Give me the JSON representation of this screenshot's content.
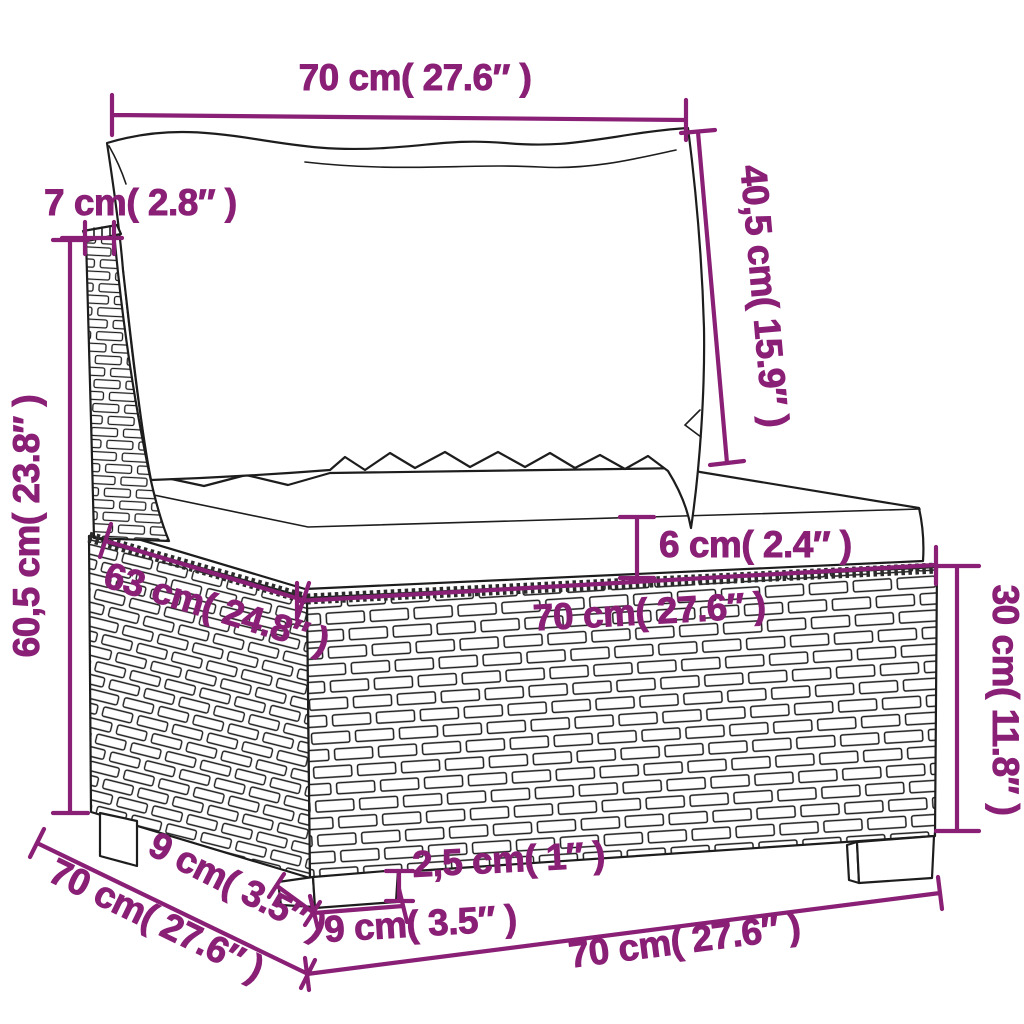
{
  "page": {
    "background": "#ffffff",
    "accent_color": "#8A1F76",
    "outline_color": "#1d1d1d"
  },
  "diagram": {
    "product": "poly rattan garden sofa middle section with back and seat cushions",
    "view": "front-left perspective line drawing with dimension annotations",
    "units": "cm (inches)",
    "dims": {
      "back_width": "70 cm( 27.6″ )",
      "back_cushion_height": "40,5 cm( 15.9″ )",
      "back_frame_thickness": "7 cm( 2.8″ )",
      "total_height": "60,5 cm( 23.8″ )",
      "seat_cushion_thickness": "6 cm( 2.4″ )",
      "seat_width": "70 cm( 27.6″ )",
      "seat_depth": "63 cm( 24.8″ )",
      "base_height": "30 cm( 11.8″ )",
      "leg_height": "2,5 cm( 1″ )",
      "leg_width": "9 cm( 3.5″ )",
      "leg_side_depth": "9 cm( 3.5″ )",
      "side_depth": "70 cm( 27.6″ )",
      "bottom_width": "70 cm( 27.6″ )"
    }
  }
}
